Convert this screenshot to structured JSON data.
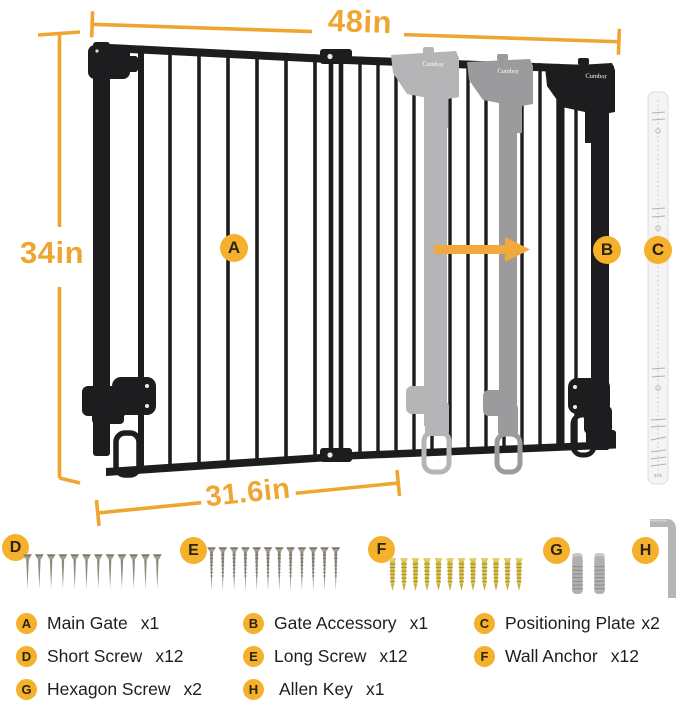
{
  "figure": {
    "brand": "Cumbor",
    "dimensions": {
      "top": "48in",
      "left": "34in",
      "bottom": "31.6in"
    },
    "plate_micro_label": "34in"
  },
  "legend": {
    "items": [
      {
        "letter": "A",
        "label": "Main Gate",
        "count": "x1"
      },
      {
        "letter": "B",
        "label": "Gate Accessory",
        "count": "x1"
      },
      {
        "letter": "C",
        "label": "Positioning Plate",
        "count": "x2"
      },
      {
        "letter": "D",
        "label": "Short Screw",
        "count": "x12"
      },
      {
        "letter": "E",
        "label": "Long Screw",
        "count": "x12"
      },
      {
        "letter": "F",
        "label": "Wall Anchor",
        "count": "x12"
      },
      {
        "letter": "G",
        "label": "Hexagon Screw",
        "count": "x2"
      },
      {
        "letter": "H",
        "label": "Allen Key",
        "count": "x1"
      }
    ]
  },
  "colors": {
    "accent": "#EFA630",
    "badge": "#F5B02C",
    "gate_black": "#1D1D1F",
    "ghost_light": "#B5B5B7",
    "ghost_mid": "#9B9B9D",
    "anchor_yellow": "#D6C044"
  }
}
